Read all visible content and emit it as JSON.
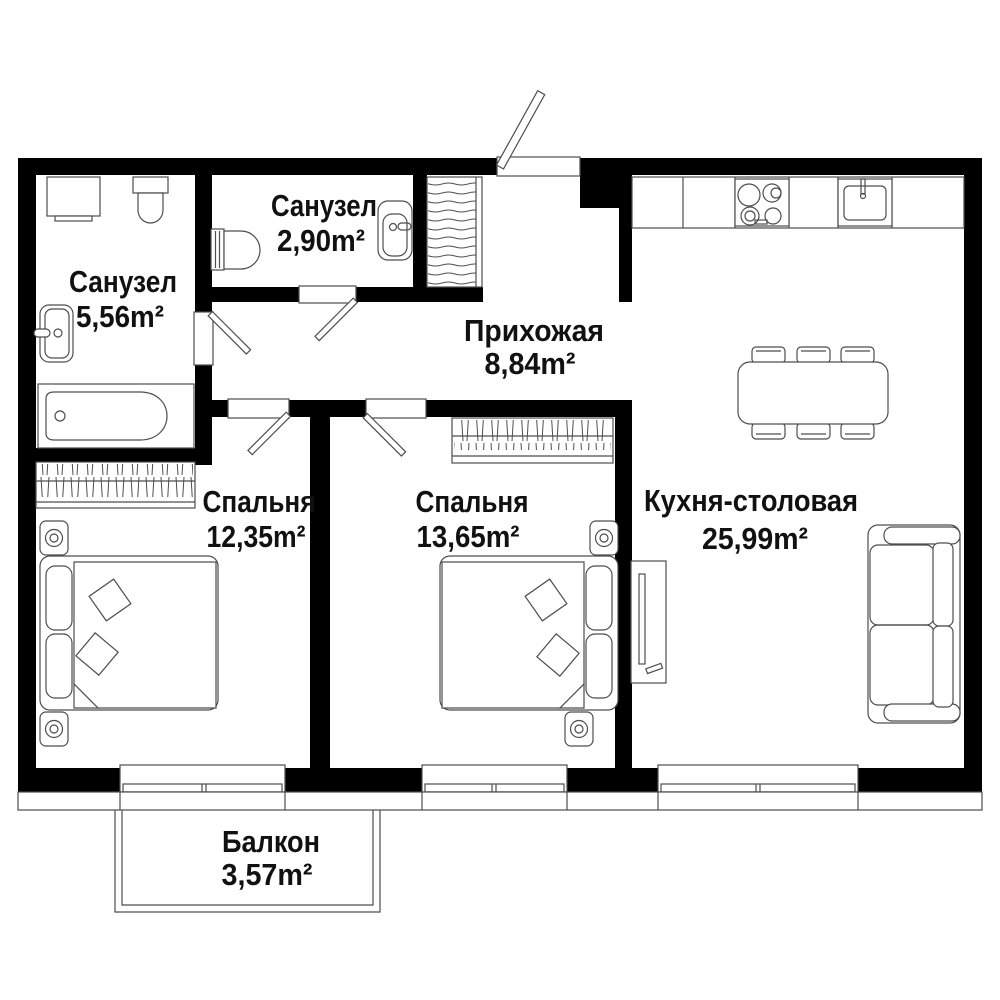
{
  "floor_plan": {
    "rooms": [
      {
        "name": "bathroom-large",
        "label": "Санузел",
        "area": "5,56m²"
      },
      {
        "name": "bathroom-small",
        "label": "Санузел",
        "area": "2,90m²"
      },
      {
        "name": "hallway",
        "label": "Прихожая",
        "area": "8,84m²"
      },
      {
        "name": "bedroom-1",
        "label": "Спальня",
        "area": "12,35m²"
      },
      {
        "name": "bedroom-2",
        "label": "Спальня",
        "area": "13,65m²"
      },
      {
        "name": "kitchen-dining",
        "label": "Кухня-столовая",
        "area": "25,99m²"
      },
      {
        "name": "balcony",
        "label": "Балкон",
        "area": "3,57m²"
      }
    ],
    "colors": {
      "wall": "#000000",
      "furniture_line": "#4d4d4d",
      "background": "#ffffff",
      "text": "#111111"
    }
  }
}
